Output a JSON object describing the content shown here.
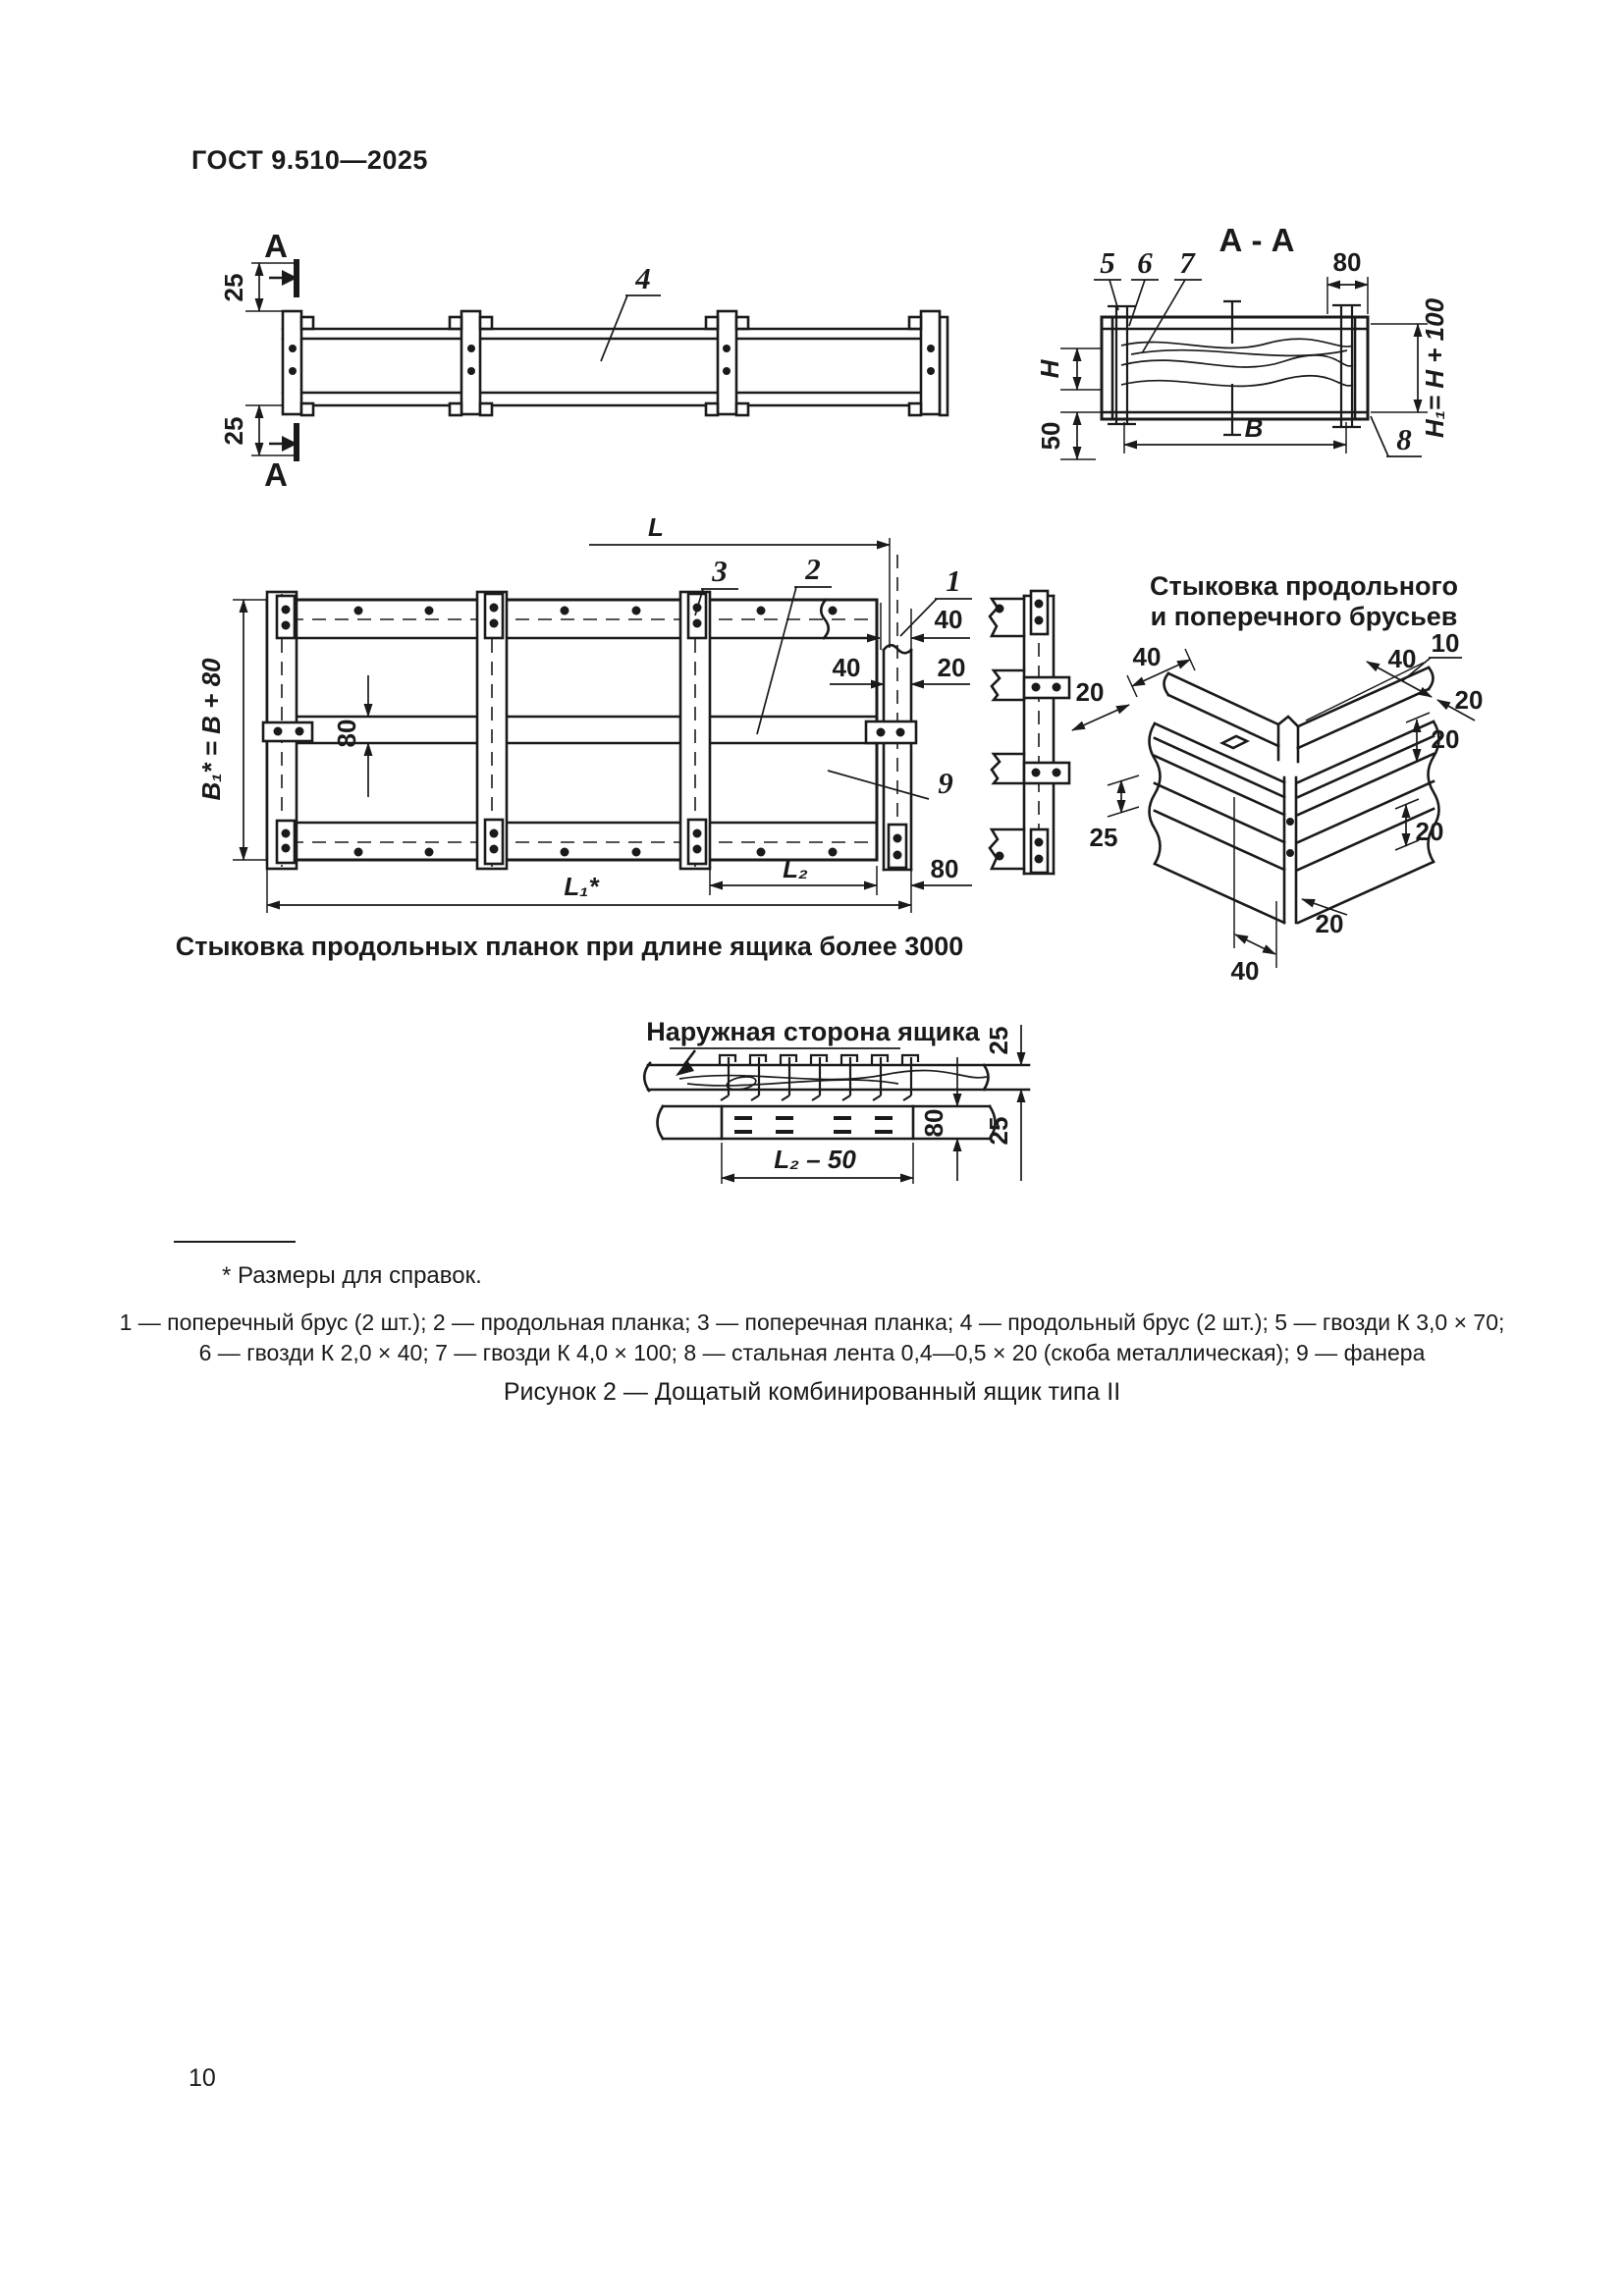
{
  "theme": {
    "ink": "#1a1a1a",
    "paper": "#ffffff"
  },
  "page": {
    "header_title": "ГОСТ 9.510—2025",
    "page_number": "10",
    "footnote": "* Размеры для справок.",
    "legend_line1": "1 — поперечный брус (2 шт.); 2 — продольная планка; 3 — поперечная планка; 4 — продольный брус (2 шт.); 5 — гвозди К 3,0 × 70;",
    "legend_line2": "6 — гвозди К 2,0 × 40; 7 — гвозди К 4,0 × 100; 8 — стальная лента 0,4—0,5 × 20 (скоба металлическая); 9 — фанера",
    "figure_caption": "Рисунок 2 — Дощатый комбинированный ящик типа II"
  },
  "side_view": {
    "section_mark_top": "А",
    "section_mark_bottom": "А",
    "dim_top": "25",
    "dim_bottom": "25",
    "part_4": "4"
  },
  "section_view": {
    "title": "А - А",
    "part_5": "5",
    "part_6": "6",
    "part_7": "7",
    "part_8": "8",
    "dim_80": "80",
    "dim_h": "H",
    "dim_50": "50",
    "dim_b": "В",
    "dim_h1": "H₁= H + 100"
  },
  "plan_view": {
    "dim_l": "L",
    "dim_b1": "B₁* = B + 80",
    "dim_80_mid": "80",
    "dim_40_a": "40",
    "dim_40_b": "40",
    "dim_20": "20",
    "dim_l2": "L₂",
    "dim_80_right": "80",
    "dim_l1": "L₁*",
    "part_1": "1",
    "part_2": "2",
    "part_3": "3",
    "part_9": "9",
    "caption": "Стыковка продольных планок при длине ящика более 3000"
  },
  "corner_joint": {
    "title_line1": "Стыковка продольного",
    "title_line2": "и поперечного брусьев",
    "dim_40_tl": "40",
    "dim_20_l": "20",
    "dim_40_tr": "40",
    "dim_10": "10",
    "dim_20_r1": "20",
    "dim_20_r2": "20",
    "dim_20_r3": "20",
    "dim_25_l": "25",
    "dim_20_b": "20",
    "dim_40_b": "40"
  },
  "outer_side_view": {
    "title": "Наружная сторона ящика",
    "dim_25_top": "25",
    "dim_80": "80",
    "dim_25_right": "25",
    "dim_l2_50": "L₂ – 50"
  }
}
